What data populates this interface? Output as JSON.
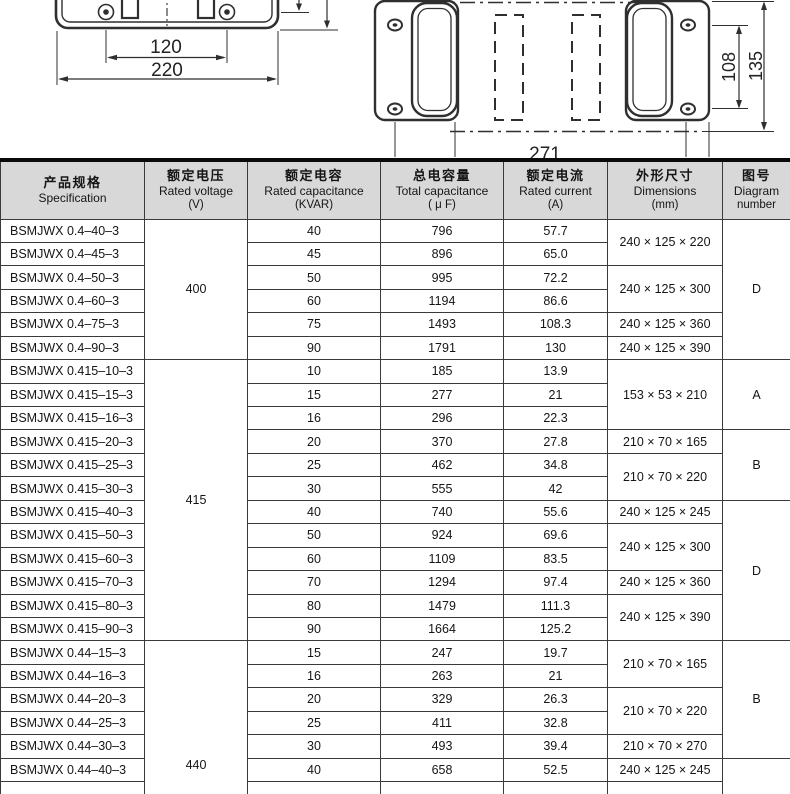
{
  "drawings": {
    "front_view": {
      "dims": {
        "inner": "120",
        "outer": "220"
      }
    },
    "top_view": {
      "dims": {
        "inner": "108",
        "outer": "135",
        "width": "271"
      }
    }
  },
  "table": {
    "header": {
      "columns": [
        {
          "zh": "产品规格",
          "en": "Specification",
          "unit": ""
        },
        {
          "zh": "额定电压",
          "en": "Rated voltage",
          "unit": "(V)"
        },
        {
          "zh": "额定电容",
          "en": "Rated capacitance",
          "unit": "(KVAR)"
        },
        {
          "zh": "总电容量",
          "en": "Total capacitance",
          "unit": "( μ F)"
        },
        {
          "zh": "额定电流",
          "en": "Rated current",
          "unit": "(A)"
        },
        {
          "zh": "外形尺寸",
          "en": "Dimensions",
          "unit": "(mm)"
        },
        {
          "zh": "图号",
          "en": "Diagram",
          "unit": "number"
        }
      ]
    },
    "rows": [
      [
        "BSMJWX 0.4–40–3",
        "40",
        "796",
        "57.7"
      ],
      [
        "BSMJWX 0.4–45–3",
        "45",
        "896",
        "65.0"
      ],
      [
        "BSMJWX 0.4–50–3",
        "50",
        "995",
        "72.2"
      ],
      [
        "BSMJWX 0.4–60–3",
        "60",
        "1194",
        "86.6"
      ],
      [
        "BSMJWX 0.4–75–3",
        "75",
        "1493",
        "108.3"
      ],
      [
        "BSMJWX 0.4–90–3",
        "90",
        "1791",
        "130"
      ],
      [
        "BSMJWX 0.415–10–3",
        "10",
        "185",
        "13.9"
      ],
      [
        "BSMJWX 0.415–15–3",
        "15",
        "277",
        "21"
      ],
      [
        "BSMJWX 0.415–16–3",
        "16",
        "296",
        "22.3"
      ],
      [
        "BSMJWX 0.415–20–3",
        "20",
        "370",
        "27.8"
      ],
      [
        "BSMJWX 0.415–25–3",
        "25",
        "462",
        "34.8"
      ],
      [
        "BSMJWX 0.415–30–3",
        "30",
        "555",
        "42"
      ],
      [
        "BSMJWX 0.415–40–3",
        "40",
        "740",
        "55.6"
      ],
      [
        "BSMJWX 0.415–50–3",
        "50",
        "924",
        "69.6"
      ],
      [
        "BSMJWX 0.415–60–3",
        "60",
        "1109",
        "83.5"
      ],
      [
        "BSMJWX 0.415–70–3",
        "70",
        "1294",
        "97.4"
      ],
      [
        "BSMJWX 0.415–80–3",
        "80",
        "1479",
        "111.3"
      ],
      [
        "BSMJWX 0.415–90–3",
        "90",
        "1664",
        "125.2"
      ],
      [
        "BSMJWX 0.44–15–3",
        "15",
        "247",
        "19.7"
      ],
      [
        "BSMJWX 0.44–16–3",
        "16",
        "263",
        "21"
      ],
      [
        "BSMJWX 0.44–20–3",
        "20",
        "329",
        "26.3"
      ],
      [
        "BSMJWX 0.44–25–3",
        "25",
        "411",
        "32.8"
      ],
      [
        "BSMJWX 0.44–30–3",
        "30",
        "493",
        "39.4"
      ],
      [
        "BSMJWX 0.44–40–3",
        "40",
        "658",
        "52.5"
      ]
    ],
    "voltage_groups": [
      {
        "label": "400",
        "start": 0,
        "span": 6
      },
      {
        "label": "415",
        "start": 6,
        "span": 12
      },
      {
        "label": "440",
        "start": 18,
        "span": 7,
        "align": "low"
      }
    ],
    "dimension_groups": [
      {
        "label": "240 × 125 × 220",
        "start": 0,
        "span": 2
      },
      {
        "label": "240 × 125 × 300",
        "start": 2,
        "span": 2
      },
      {
        "label": "240 × 125 × 360",
        "start": 4,
        "span": 1
      },
      {
        "label": "240 × 125 × 390",
        "start": 5,
        "span": 1
      },
      {
        "label": "153 × 53 × 210",
        "start": 6,
        "span": 3
      },
      {
        "label": "210 × 70 × 165",
        "start": 9,
        "span": 1
      },
      {
        "label": "210 × 70 × 220",
        "start": 10,
        "span": 2
      },
      {
        "label": "240 × 125 × 245",
        "start": 12,
        "span": 1
      },
      {
        "label": "240 × 125 × 300",
        "start": 13,
        "span": 2
      },
      {
        "label": "240 × 125 × 360",
        "start": 15,
        "span": 1
      },
      {
        "label": "240 × 125 × 390",
        "start": 16,
        "span": 2
      },
      {
        "label": "210 × 70 × 165",
        "start": 18,
        "span": 2
      },
      {
        "label": "210 × 70 × 220",
        "start": 20,
        "span": 2
      },
      {
        "label": "210 × 70 × 270",
        "start": 22,
        "span": 1
      },
      {
        "label": "240 × 125 × 245",
        "start": 23,
        "span": 1
      },
      {
        "label": "",
        "start": 24,
        "span": 1
      }
    ],
    "diagram_groups": [
      {
        "label": "D",
        "start": 0,
        "span": 6
      },
      {
        "label": "A",
        "start": 6,
        "span": 3
      },
      {
        "label": "B",
        "start": 9,
        "span": 3
      },
      {
        "label": "D",
        "start": 12,
        "span": 6
      },
      {
        "label": "B",
        "start": 18,
        "span": 5
      },
      {
        "label": "",
        "start": 23,
        "span": 2
      }
    ]
  }
}
